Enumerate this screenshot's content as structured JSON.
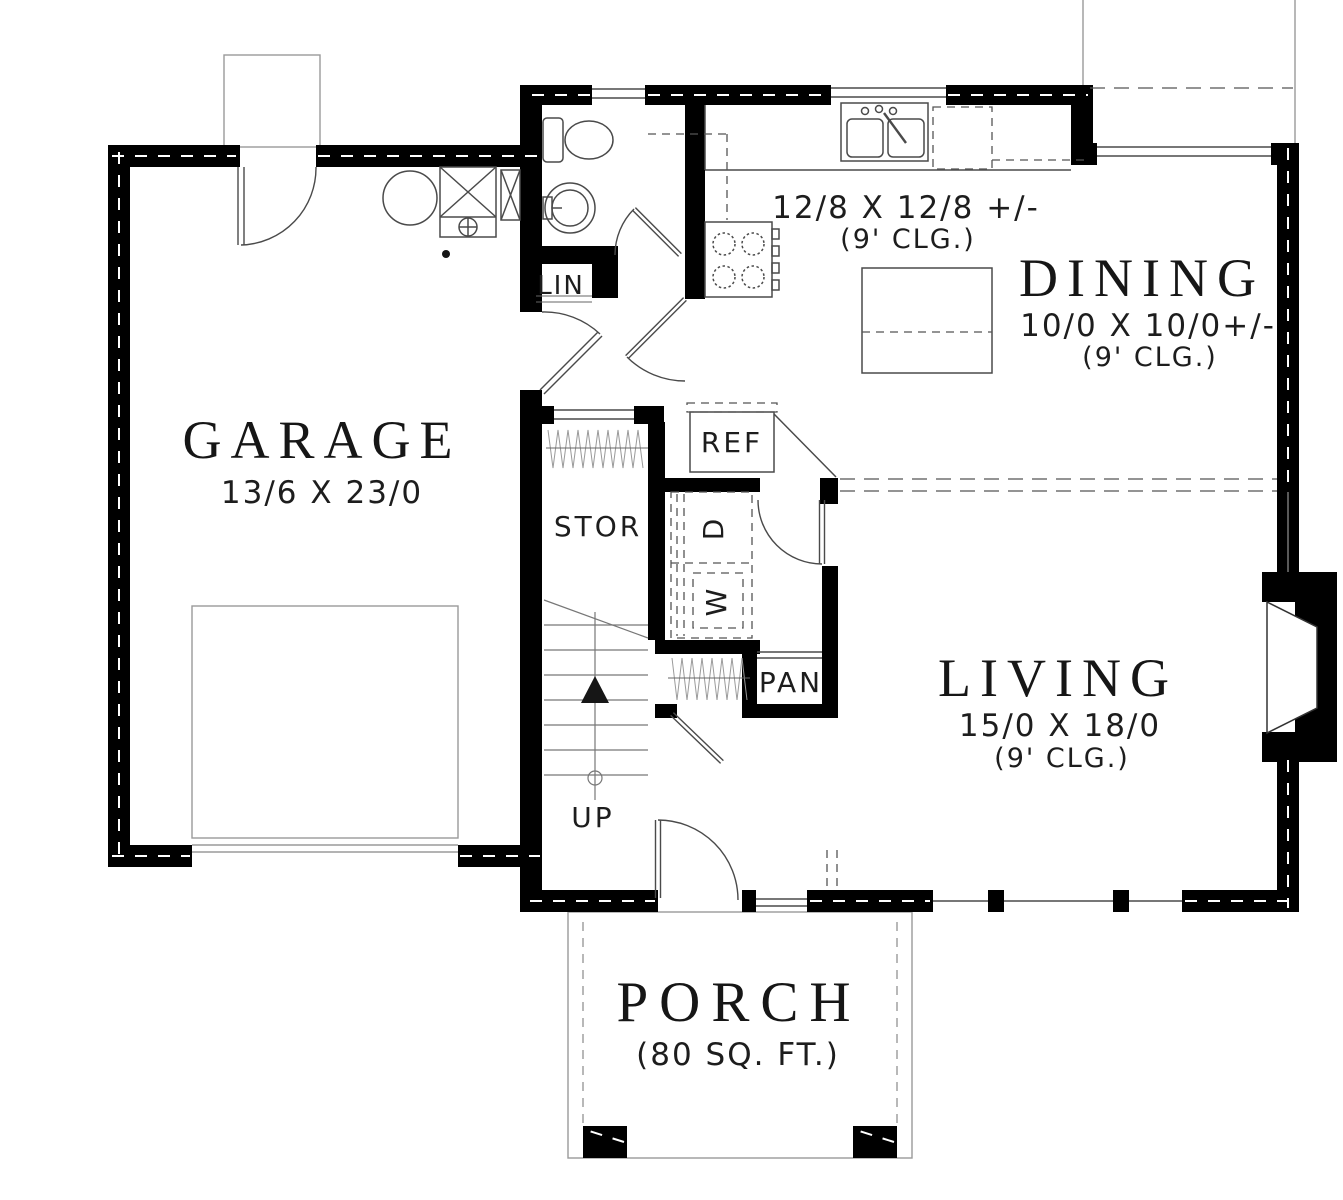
{
  "plan_title": "First floor plan",
  "rooms": {
    "garage": {
      "name": "GARAGE",
      "dims": "13/6 X 23/0"
    },
    "kitchen": {
      "dims": "12/8 X 12/8 +/-",
      "ceiling": "(9' CLG.)"
    },
    "dining": {
      "name": "DINING",
      "dims": "10/0 X 10/0+/-",
      "ceiling": "(9' CLG.)"
    },
    "living": {
      "name": "LIVING",
      "dims": "15/0 X 18/0",
      "ceiling": "(9' CLG.)"
    },
    "porch": {
      "name": "PORCH",
      "area": "(80 SQ. FT.)"
    },
    "storage": {
      "label": "STOR"
    },
    "linen": {
      "label": "LIN"
    },
    "pantry": {
      "label": "PAN"
    },
    "refrigerator": {
      "label": "REF"
    },
    "washer": {
      "label": "W"
    },
    "dryer": {
      "label": "D"
    },
    "stairs": {
      "label": "UP"
    }
  },
  "colors": {
    "wall": "#000000",
    "fixture_line": "#4a4a4a",
    "light_line": "#9a9a9a",
    "text": "#161616",
    "background": "#ffffff"
  }
}
